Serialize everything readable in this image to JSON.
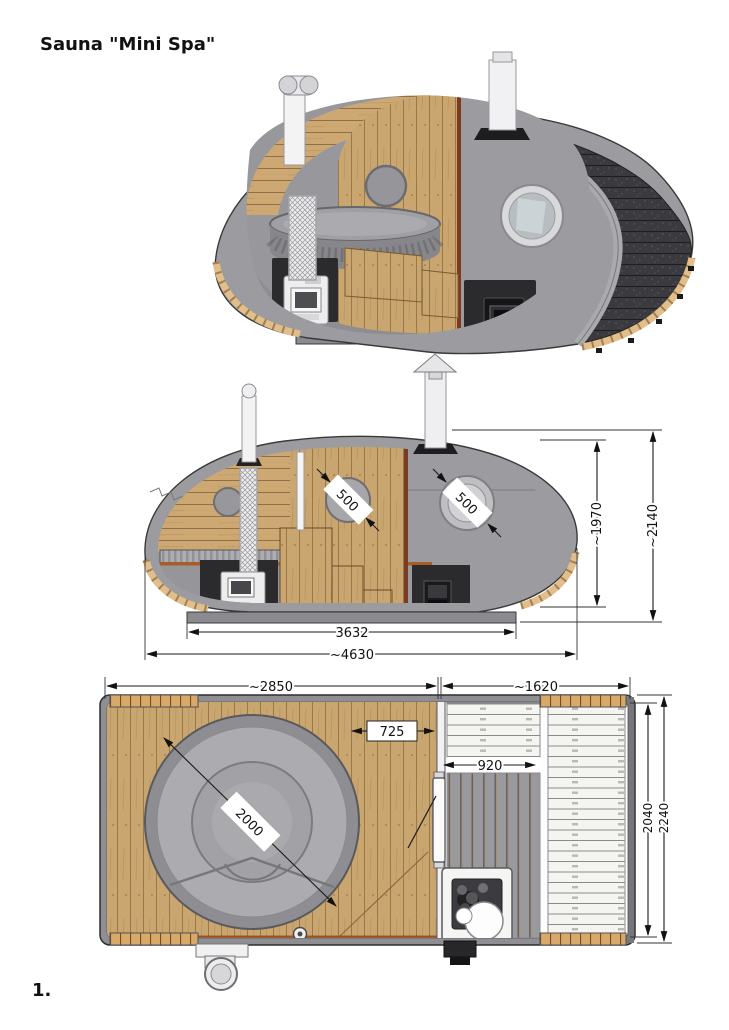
{
  "page": {
    "title": "Sauna \"Mini Spa\"",
    "figure_label": "1."
  },
  "side_section": {
    "sauna_window_diameter": "500",
    "entry_window_diameter": "500",
    "interior_height": "~1970",
    "overall_height": "~2140",
    "floor_length": "3632",
    "overall_length": "~4630"
  },
  "plan": {
    "hot_tub_room_length": "~2850",
    "sauna_room_length": "~1620",
    "deck_strip_width": "725",
    "sauna_floor_width": "920",
    "hot_tub_diameter": "2000",
    "interior_width": "2040",
    "overall_width": "2240"
  },
  "colors": {
    "shell_gray": "#9c9ca0",
    "roof_shingles": "#3b3b3f",
    "wood": "#c9a570",
    "wood_trim": "#d9a96a",
    "deck_trim_orange": "#a85c28",
    "partition_brown": "#7a3b22",
    "stove_dark": "#2b2b2e",
    "dimension_ink": "#111111"
  }
}
